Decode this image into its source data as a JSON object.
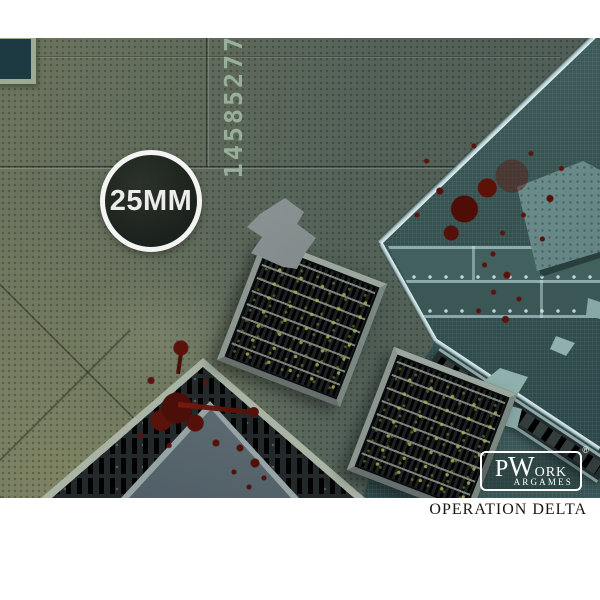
{
  "badge": {
    "label": "25MM"
  },
  "mat": {
    "stencil_number": "14585277",
    "colors": {
      "mat_green": "#57645a",
      "olive": "#7d8468",
      "teal_platform": "#35504f",
      "blue_panel": "#5c6a72",
      "grate_frame": "#9aa69e",
      "blood": "#5a1109",
      "frame_white": "#ffffff"
    }
  },
  "brand": {
    "p": "P",
    "w": "W",
    "ork": "ORK",
    "argames": "ARGAMES",
    "registered": "®"
  },
  "footer": {
    "title": "OPERATION DELTA"
  }
}
